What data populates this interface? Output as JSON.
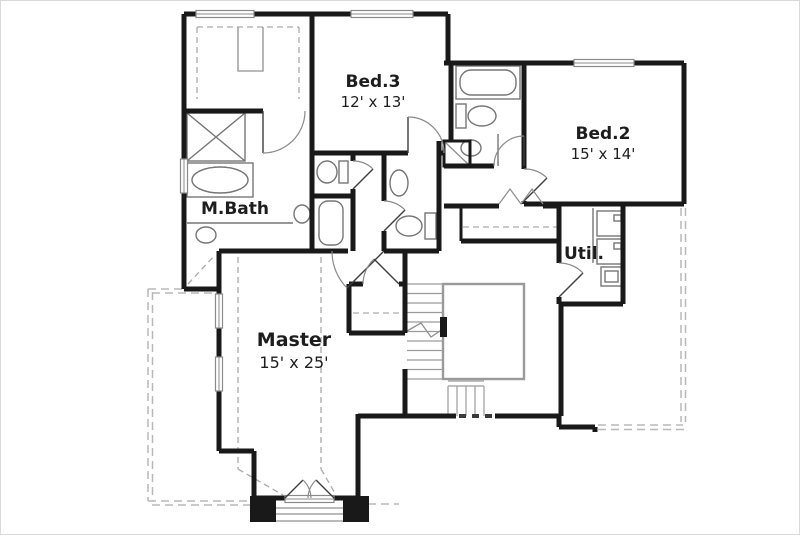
{
  "plan": {
    "rooms": [
      {
        "name": "Bed.3",
        "dims": "12' x 13'"
      },
      {
        "name": "Bed.2",
        "dims": "15' x 14'"
      },
      {
        "name": "M.Bath",
        "dims": ""
      },
      {
        "name": "Util.",
        "dims": ""
      },
      {
        "name": "Master",
        "dims": "15' x 25'"
      }
    ],
    "colors": {
      "wall": "#191919",
      "fixture": "#767676",
      "roof_dash": "#b8b8b8",
      "text": "#1d1d1d",
      "background": "#ffffff"
    }
  }
}
